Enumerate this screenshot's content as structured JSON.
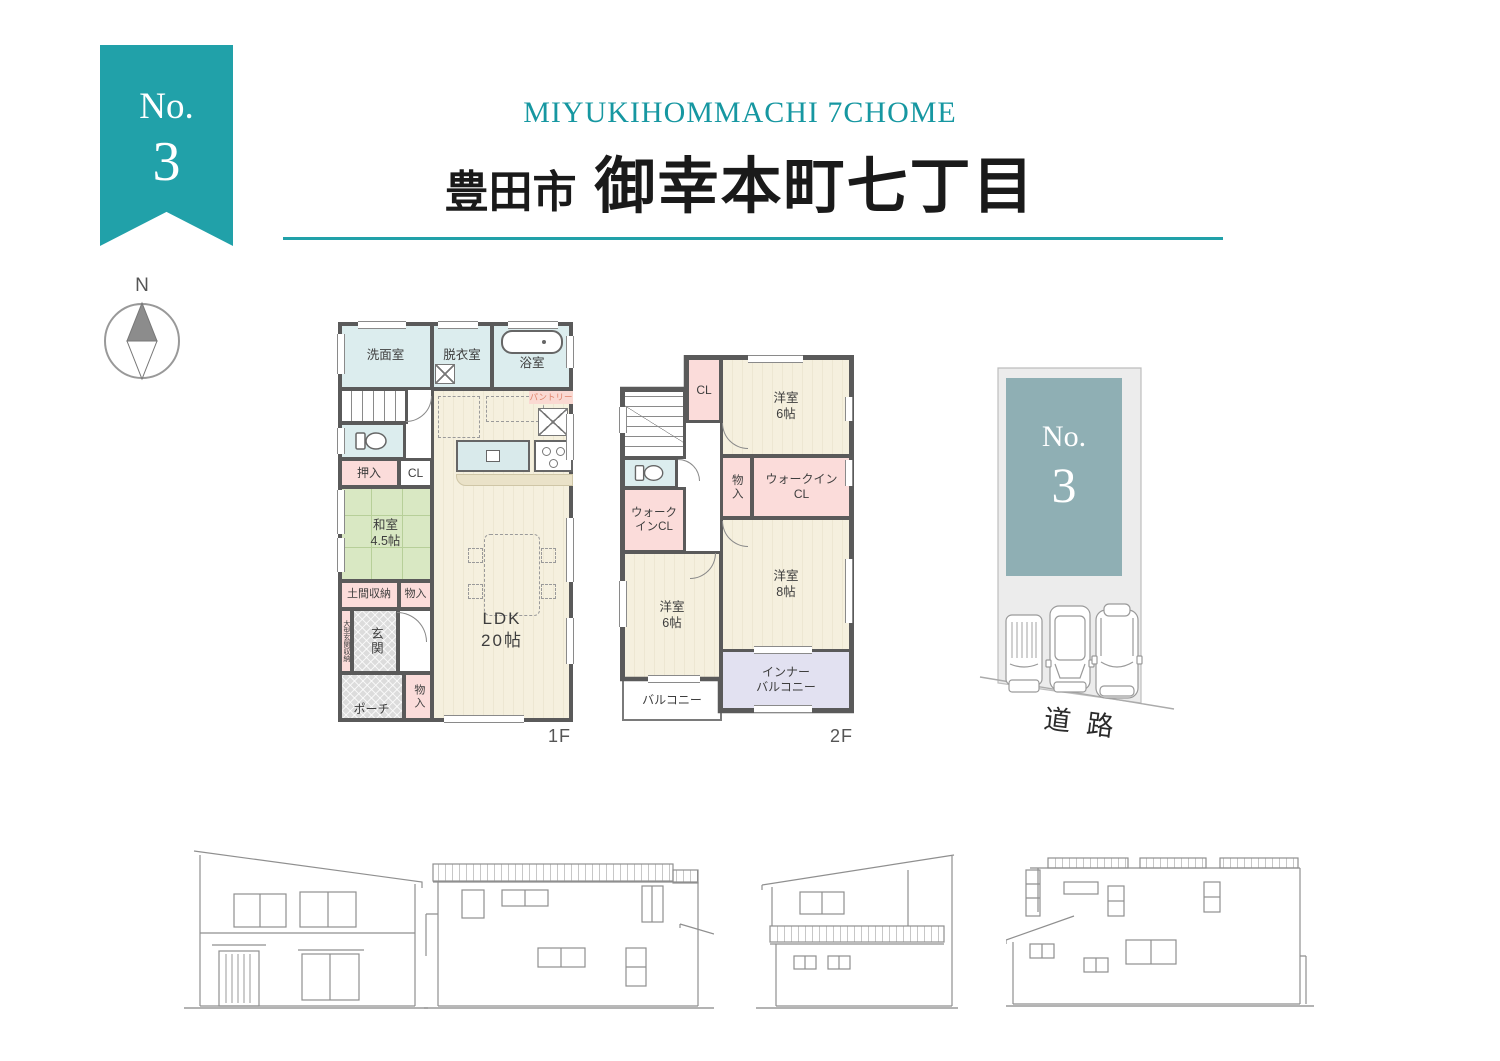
{
  "header": {
    "subtitle_en": "MIYUKIHOMMACHI 7CHOME",
    "city": "豊田市",
    "district": "御幸本町七丁目"
  },
  "ribbon": {
    "prefix": "No.",
    "number": "3"
  },
  "compass": {
    "north": "N"
  },
  "floor1": {
    "label": "1F",
    "rooms": {
      "senmen": "洗面室",
      "datsui": "脱衣室",
      "yokushitsu": "浴室",
      "pantry": "パントリー",
      "oshiire": "押入",
      "cl": "CL",
      "washitsu_name": "和室",
      "washitsu_size": "4.5帖",
      "doma": "土間収納",
      "monoiri_mid": "物入",
      "ogata_genkan": "大型玄関収納",
      "genkan": "玄関",
      "porch": "ポーチ",
      "monoiri_bottom": "物入",
      "ldk_name": "LDK",
      "ldk_size": "20帖"
    }
  },
  "floor2": {
    "label": "2F",
    "rooms": {
      "cl": "CL",
      "bedroom6_top_name": "洋室",
      "bedroom6_top_size": "6帖",
      "monoiri": "物入",
      "wic_right_line1": "ウォークイン",
      "wic_right_line2": "CL",
      "wic_left_line1": "ウォーク",
      "wic_left_line2": "インCL",
      "bedroom8_name": "洋室",
      "bedroom8_size": "8帖",
      "bedroom6_low_name": "洋室",
      "bedroom6_low_size": "6帖",
      "balcony": "バルコニー",
      "inner_balcony_line1": "インナー",
      "inner_balcony_line2": "バルコニー"
    }
  },
  "site_plan": {
    "prefix": "No.",
    "number": "3",
    "road_label": "道路"
  },
  "colors": {
    "accent_teal": "#21A1A9",
    "subtitle_teal": "#1697A1",
    "site_block_teal": "#8FAFB4",
    "wall_gray": "#5A5A5A",
    "room_blue": "#DCEDEE",
    "room_beige": "#F4EFDC",
    "room_green": "#D9E8C3",
    "room_pink": "#FBDCDA",
    "room_lavender": "#E2E1F1",
    "room_gray_hatch": "#D8D8D8"
  }
}
